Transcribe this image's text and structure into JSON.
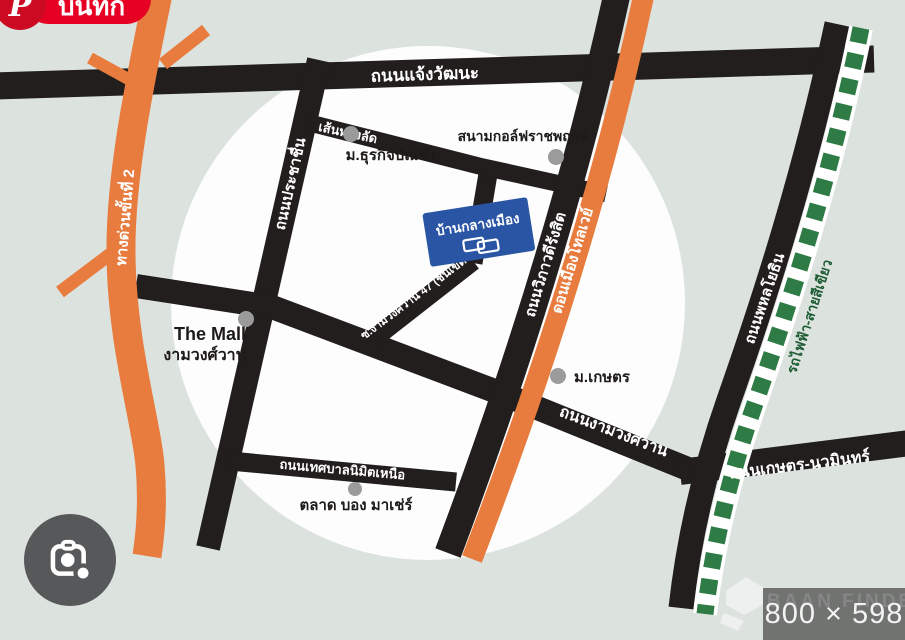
{
  "pinterest": {
    "save_label": "บันทึก",
    "logo_letter": "P"
  },
  "footer": {
    "dimensions": "800 × 598",
    "watermark": "BAAN FINDER"
  },
  "map": {
    "roads": {
      "chaengwatthana": "ถนนแจ้งวัฒนะ",
      "expressway2": "ทางด่วนขั้นที่ 2",
      "prachachuen": "ถนนประชาชื่น",
      "shortcut": "เส้นทางลัด",
      "vibhavadi": "ถนนวิภาวดีรังสิต",
      "tollway": "ดอนเมืองโทลเวย์",
      "phahonyothin": "ถนนพหลโยธิน",
      "green_line": "รถไฟฟ้า-สายสีเขียว",
      "soi47": "ซ.งามวงศ์วาน 47 (ชินเขต 2)",
      "ngamwongwan": "ถนนงามวงศ์วาน",
      "kaset_nawamin": "ถนนเกษตร-นวมินทร์",
      "thetsaban_nimit": "ถนนเทศบาลนิมิตเหนือ"
    },
    "pois": {
      "dhurakij": "ม.ธุรกิจบัณฑิต",
      "golf": "สนามกอล์ฟราชพฤกษ์",
      "baan_klang_muang": "บ้านกลางเมือง",
      "the_mall_line1": "The Mall",
      "the_mall_line2": "งามวงศ์วาน",
      "kasetsart": "ม.เกษตร",
      "market": "ตลาด บอง มาเช่ร์"
    },
    "colors": {
      "background": "#dce2de",
      "highlight_circle": "#fcfdfc",
      "road_black": "#211e1d",
      "road_orange": "#e87c3e",
      "green_line": "#2e7b45",
      "green_line_text": "#1e5c34",
      "blue_label": "#2a55a4",
      "pinterest_red": "#e60023",
      "marker_gray": "#9b9b9b"
    }
  }
}
